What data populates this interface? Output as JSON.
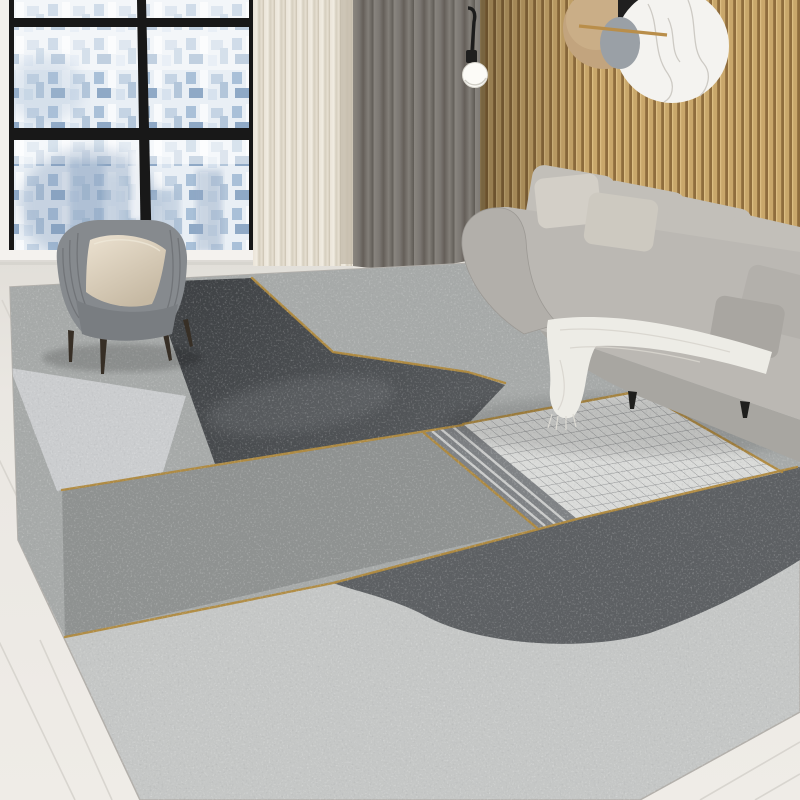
{
  "scene": {
    "type": "interior product photograph",
    "description": "Modern living room with a large geometric grey area rug with gold accent lines, grey sofa, grey armchair with cream pillow, floor-to-ceiling window with aerial city view, cream and grey curtains, wood slat accent wall with round marble wall decor and a globe pendant lamp.",
    "labels": {
      "window": "city-view-window",
      "city": "aerial-city-view",
      "curtain_cream": "cream-curtain",
      "curtain_gray": "gray-curtain",
      "pendant": "globe-pendant-lamp",
      "slat_wall": "wood-slat-accent-wall",
      "wall_decor": "round-marble-wall-decor",
      "sofa": "gray-fabric-sofa",
      "blanket": "white-throw-blanket",
      "armchair": "gray-armchair",
      "chair_pillow": "cream-accent-pillow",
      "rug": "geometric-gray-rug-with-gold-lines",
      "floor": "light-wood-floor"
    },
    "palette": {
      "wall": "#f2f0ec",
      "floor": "#eae7e2",
      "floor_line": "#d8d5cf",
      "frame_black": "#181818",
      "sill": "#f4f2ee",
      "curtain_cream": "#e8e2d5",
      "curtain_gray": "#7a7671",
      "slat_light": "#c9a76b",
      "slat_dark": "#8f6d3d",
      "marble": "#f4f3f0",
      "marble_vein": "#c9c6c0",
      "disc_tan": "#c2a47e",
      "disc_gray": "#9aa0a6",
      "metal_black": "#1f1f1f",
      "gold_rod": "#b98e4a",
      "lamp_white": "#fcfbf7",
      "sofa_body": "#bbb8b3",
      "sofa_front": "#a8a6a1",
      "sofa_cushion": "#c2bfb9",
      "sofa_pillow": "#d3cfc7",
      "sofa_pillow2": "#cdc9c0",
      "side_pillow": "#b3b0ab",
      "blanket": "#edece6",
      "leg_black": "#1f1f1d",
      "chair_body": "#868a8e",
      "chair_seat": "#797d81",
      "chair_pillow": "#ddd2c0",
      "chair_leg": "#372f26",
      "rug_light": "#c5c7c6",
      "rug_top": "#a7aaa9",
      "rug_medium": "#8f9291",
      "rug_dark": "#45484b",
      "rug_ellipse": "#5d6063",
      "rug_panel": "#cbcdcf",
      "rug_grid_bg": "#dadbd9",
      "rug_grid_line": "#8e9092",
      "rug_band": "#7f8285",
      "rug_band_stripe": "#d4d5d3",
      "rug_gold": "#b08a3e",
      "shadow": "#000000"
    }
  }
}
